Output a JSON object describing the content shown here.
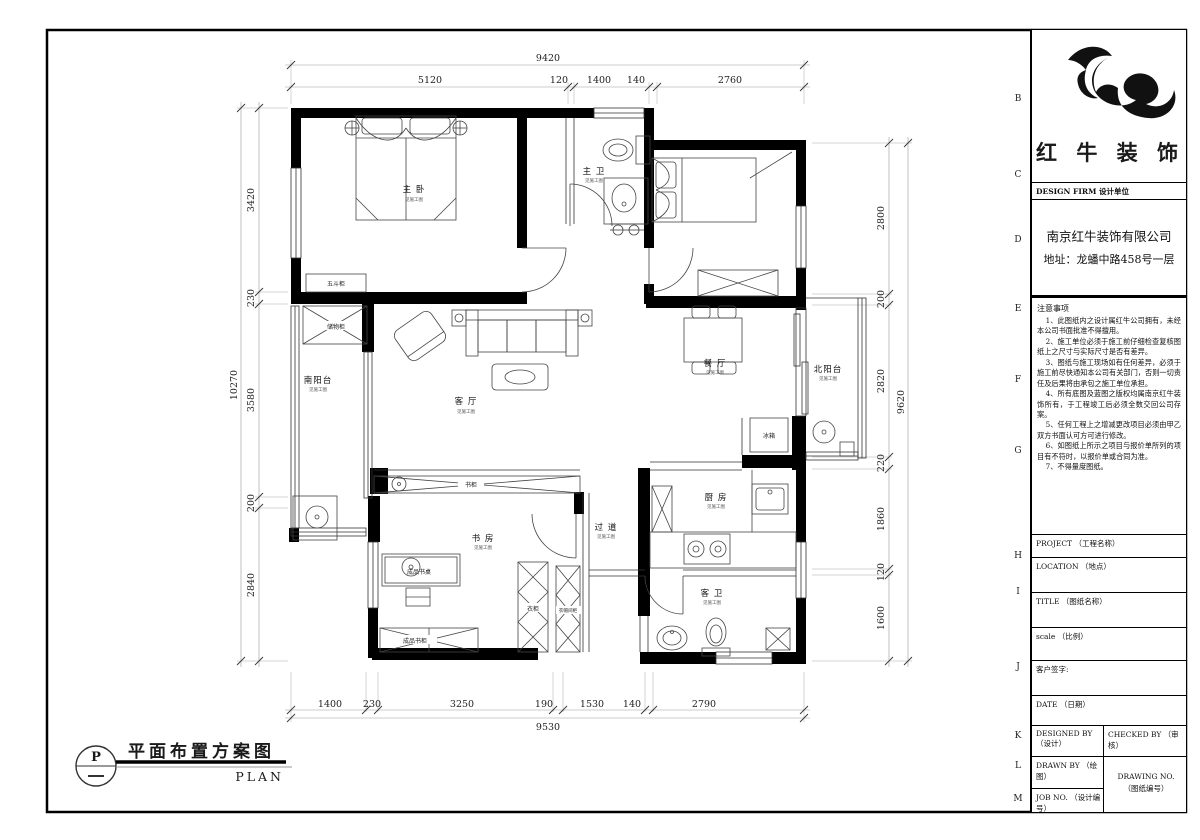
{
  "sheet": {
    "row_letters": [
      "B",
      "C",
      "D",
      "E",
      "F",
      "G",
      "H",
      "I",
      "J",
      "K",
      "L",
      "M"
    ],
    "bottom_title": {
      "symbol": "P",
      "title": "平面布置方案图",
      "subtitle": "PLAN"
    }
  },
  "title_block": {
    "logo_text": "红 牛 装 饰",
    "design_firm_header": "DESIGN FIRM  设计单位",
    "company": "南京红牛装饰有限公司",
    "address": "地址：龙蟠中路458号一层",
    "notes_title": "注意事项",
    "notes": [
      "1、此图纸内之设计属红牛公司拥有，未经本公司书面批准不得擅用。",
      "2、施工单位必须于施工前仔细检查复核图纸上之尺寸与实际尺寸是否有差异。",
      "3、图纸与施工现场如有任何差异，必须于施工前尽快通知本公司有关部门，否则一切责任及后果将由承包之施工单位承担。",
      "4、所有底图及蓝图之版权均属南京红牛装饰所有，于工程竣工后必须全数交回公司存案。",
      "5、任何工程上之增减更改项目必须由甲乙双方书面认可方可进行修改。",
      "6、如图纸上所示之项目与报价单所列的项目有不符时，以报价单或合同为准。",
      "7、不得量度图纸。"
    ],
    "fields": {
      "project": "PROJECT （工程名称）",
      "location": "LOCATION （地点）",
      "title": "TITLE （图纸名称）",
      "scale": "scale （比例）",
      "signature": "客户签字:",
      "date": "DATE （日期）",
      "designed_by": "DESIGNED BY （设计）",
      "checked_by": "CHECKED BY （审核）",
      "drawn_by": "DRAWN BY （绘图）",
      "drawing_no_1": "DRAWING NO.",
      "drawing_no_2": "（图纸编号）",
      "job_no": "JOB NO. （设计编号）"
    }
  },
  "dimensions": {
    "top": {
      "total": "9420",
      "segments": [
        "5120",
        "120",
        "1400",
        "140",
        "2760"
      ]
    },
    "bottom": {
      "total": "9530",
      "segments": [
        "1400",
        "230",
        "3250",
        "190",
        "1530",
        "140",
        "2790"
      ]
    },
    "left": {
      "total": "10270",
      "segments": [
        "3420",
        "230",
        "3580",
        "200",
        "2840"
      ]
    },
    "right": {
      "total": "9620",
      "segments": [
        "2800",
        "200",
        "2820",
        "220",
        "1860",
        "120",
        "1600"
      ]
    }
  },
  "rooms": {
    "master_bedroom": {
      "name": "主 卧",
      "note": "见施工图"
    },
    "master_bath": {
      "name": "主 卫",
      "note": "见施工图"
    },
    "living": {
      "name": "客 厅",
      "note": "见施工图"
    },
    "dining": {
      "name": "餐 厅",
      "note": "见施工图"
    },
    "south_balcony": {
      "name": "南阳台",
      "note": "见施工图"
    },
    "north_balcony": {
      "name": "北阳台",
      "note": "见施工图"
    },
    "kitchen": {
      "name": "厨 房",
      "note": "见施工图"
    },
    "hallway": {
      "name": "过 道",
      "note": "见施工图"
    },
    "study": {
      "name": "书 房",
      "note": "见施工图"
    },
    "guest_bath": {
      "name": "客 卫",
      "note": "见施工图"
    }
  },
  "fixtures": {
    "five_drawer": "五斗柜",
    "storage": "储物柜",
    "fridge": "冰箱",
    "bookcase": "书柜",
    "desk": "成品书桌",
    "bookcase2": "成品书柜",
    "wardrobe": "衣柜",
    "cloak_cabinet": "衣帽间柜"
  }
}
